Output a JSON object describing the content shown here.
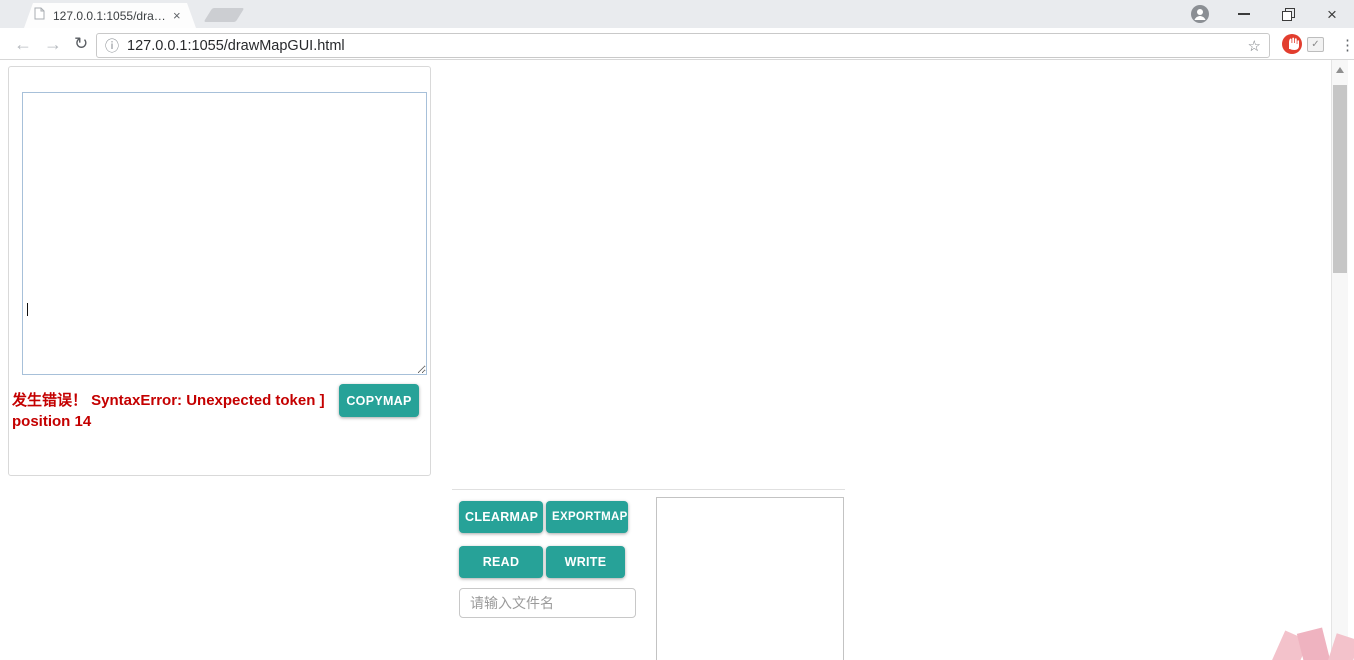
{
  "browser": {
    "tab_title": "127.0.0.1:1055/drawMa",
    "url": "127.0.0.1:1055/drawMapGUI.html",
    "glyphs": {
      "back": "←",
      "forward": "→",
      "reload": "↻",
      "info": "ⓘ",
      "star": "☆",
      "check": "✓",
      "menu": "⋮",
      "tab_close": "×",
      "window_close": "×"
    }
  },
  "matrix_panel": {
    "col_headers": [
      "0",
      "1",
      "2",
      "3",
      "4",
      "5",
      "6",
      "7",
      "8",
      "9",
      "10",
      "11",
      "12"
    ],
    "row_labels": [
      "0",
      "1",
      "2",
      "3",
      "4",
      "5",
      "6",
      "7",
      "8",
      "9",
      "10",
      "11",
      "12"
    ],
    "error_text": "发生错误！ SyntaxError: Unexpected token ] position 14",
    "copymap_label": "COPYMAP"
  },
  "map": {
    "matrix": [
      [
        29,
        0,
        29,
        0,
        27,
        3,
        204,
        3,
        32,
        0,
        206,
        0,
        28
      ],
      [
        209,
        3,
        3,
        206,
        81,
        34,
        203,
        28,
        221,
        27,
        0,
        3,
        47
      ],
      [
        0,
        31,
        0,
        217,
        0,
        202,
        0,
        3,
        0,
        3,
        82,
        0,
        205
      ],
      [
        221,
        3,
        3,
        32,
        3,
        3,
        202,
        0,
        33,
        3,
        0,
        3,
        31
      ],
      [
        0,
        81,
        27,
        3,
        47,
        203,
        0,
        3,
        203,
        28,
        202,
        81,
        28
      ],
      [
        21,
        3,
        215,
        32,
        0,
        27,
        205,
        3,
        0,
        3,
        0,
        3,
        3
      ],
      [
        206,
        3,
        3,
        0,
        82,
        3,
        34,
        81,
        29,
        0,
        0,
        209,
        21
      ],
      [
        0,
        3,
        28,
        221,
        31,
        3,
        0,
        3,
        3,
        221,
        3,
        3,
        0
      ],
      [
        27,
        3,
        3,
        3,
        201,
        3,
        201,
        3,
        33,
        0,
        28,
        3,
        33
      ],
      [
        0,
        202,
        0,
        27,
        0,
        201,
        0,
        3,
        3,
        82,
        3,
        0,
        0
      ],
      [
        3,
        22,
        3,
        3,
        3,
        3,
        47,
        0,
        215,
        0,
        0,
        3,
        202
      ],
      [
        27,
        3,
        0,
        81,
        0,
        45,
        0,
        21,
        3,
        215,
        81,
        34,
        0
      ],
      [
        34,
        217,
        29,
        0,
        205,
        3,
        0,
        3,
        65,
        27,
        0,
        3,
        29
      ]
    ],
    "legend": {
      "0": "dark-stone",
      "3": "brick-floor",
      "21": "gold-key",
      "22": "silver-key",
      "27": "red-gem",
      "28": "blue-gem",
      "29": "green-gem",
      "31": "red-potion",
      "32": "silver-potion",
      "33": "green-potion",
      "34": "yellow-potion",
      "45": "book",
      "47": "pickaxe",
      "65": "purple-orb",
      "81": "tan-door",
      "82": "blue-door",
      "201": "green-slime",
      "202": "red-slime",
      "203": "dark-slime",
      "204": "pale-slime",
      "205": "small-bat",
      "206": "big-bat",
      "209": "skeleton",
      "215": "stone-face",
      "217": "ghost",
      "221": "golem"
    }
  },
  "controls": {
    "clearmap_label": "CLEARMAP",
    "exportmap_label": "EXPORTMAP",
    "read_label": "READ",
    "write_label": "WRITE",
    "filename_placeholder": "请输入文件名",
    "output_value": ""
  },
  "tileset": {
    "terrain_column": [
      "dark-stone",
      "dirt",
      "gray-stone",
      "brick",
      "starfield",
      "lava",
      "stripes",
      "bars",
      "stairs",
      "tan-door",
      "blue-door",
      "red-door",
      "green-door",
      "snowflake",
      "pillar",
      "wing-ledge-lavender",
      "wing-ledge-lavender",
      "wing-ledge-pink",
      "wing-ledge-pink"
    ],
    "monster_rows": [
      "green-slime",
      "red-slime",
      "dark-slime",
      "crown-slime",
      "small-bat",
      "big-bat",
      "red-bat",
      "vampire",
      "skeleton",
      "armed-skeleton",
      "tan-skeleton",
      "blue-robot",
      "ape",
      "brown-golem",
      "armored-ape",
      "stone-face",
      "slime-man",
      "purple-ghost",
      "red-ghost"
    ],
    "item_rows": [
      "tan-key",
      "blue-key",
      "red-key",
      "green-key",
      "gray-key",
      "pink-key",
      "club",
      "ribbon-scroll",
      "scroll",
      "book",
      "staff",
      "medallion",
      "star",
      "wing",
      "wing",
      "wing",
      "red-gem",
      "blue-gem",
      "green-gem"
    ],
    "character_rows": [
      "blue-elder",
      "red-dwarf",
      "barbarian",
      "fairy",
      "purple-wizard",
      "red-monk",
      "king",
      "blue-prince",
      "wood-sign",
      "pink-wall",
      "lavender-wall",
      "princess"
    ]
  },
  "colors": {
    "teal": "#27a298",
    "error_red": "#c40000",
    "header_blue": "#2f55d4",
    "row_label_red": "#e8433e"
  }
}
